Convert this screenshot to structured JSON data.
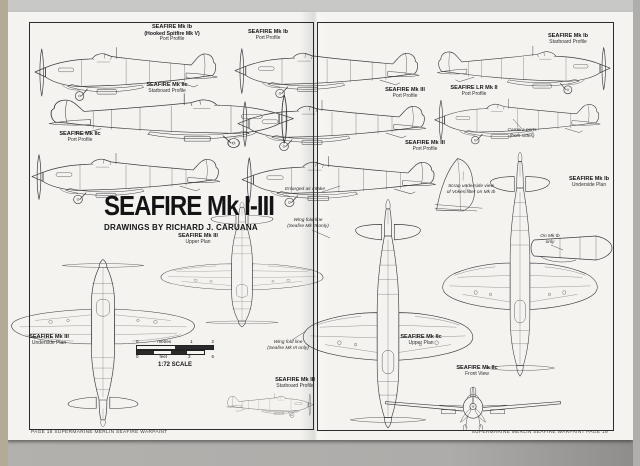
{
  "page": {
    "paper_color": "#f4f3ef",
    "ink_color": "#3b3b3f",
    "footer_left": "PAGE 18      SUPERMARINE MERLIN SEAFIRE      WARPAINT",
    "footer_right": "SUPERMARINE MERLIN SEAFIRE      WARPAINT      PAGE 19"
  },
  "title_block": {
    "title": "SEAFIRE Mk I-III",
    "subtitle": "DRAWINGS BY RICHARD J. CARUANA"
  },
  "scale_bar": {
    "metres_unit": "metres",
    "metres_ticks": [
      "0",
      "1",
      "2"
    ],
    "feet_unit": "feet",
    "feet_ticks": [
      "0",
      "3",
      "6"
    ],
    "ratio_label": "1:72 SCALE"
  },
  "labels": {
    "l1": {
      "name": "SEAFIRE Mk Ib",
      "note": "(Hooked Spitfire Mk V)",
      "view": "Port Profile"
    },
    "l2": {
      "name": "SEAFIRE Mk IIc",
      "view": "Starboard Profile"
    },
    "l3": {
      "name": "SEAFIRE Mk IIc",
      "view": "Port Profile"
    },
    "l4": {
      "name": "SEAFIRE Mk Ib",
      "view": "Port Profile"
    },
    "l5": {
      "name": "SEAFIRE Mk III",
      "view": "Port Profile"
    },
    "l6": {
      "name": "SEAFIRE Mk III",
      "view": "Port Profile"
    },
    "l7": {
      "name": "SEAFIRE Mk Ib",
      "view": "Starboard Profile"
    },
    "l8": {
      "name": "SEAFIRE LR Mk II",
      "view": "Port Profile"
    },
    "l9": {
      "name": "SEAFIRE Mk III",
      "view": "Upper Plan"
    },
    "l10": {
      "name": "SEAFIRE Mk III",
      "view": "Underside Plan"
    },
    "l11": {
      "name": "SEAFIRE Mk IIc",
      "view": "Upper Plan"
    },
    "l12": {
      "name": "SEAFIRE Mk Ib",
      "view": "Underside Plan"
    },
    "l13": {
      "name": "SEAFIRE Mk III",
      "view": "Starboard Profile"
    },
    "l14": {
      "name": "SEAFIRE Mk IIc",
      "view": "Front View"
    }
  },
  "annotations": {
    "a1": {
      "line1": "Enlarged air intake",
      "line2": ""
    },
    "a2": {
      "line1": "Wing fold-line",
      "line2": "(Seafire Mk III only)"
    },
    "a3": {
      "line1": "Wing fold line",
      "line2": "(Seafire Mk III only)"
    },
    "a4": {
      "line1": "Camera ports",
      "line2": "(both sides)"
    },
    "a5": {
      "line1": "Scrap underside view",
      "line2": "of Vokes filter on Mk Ib"
    },
    "a6": {
      "line1": "On Mk Ib",
      "line2": "only"
    }
  }
}
